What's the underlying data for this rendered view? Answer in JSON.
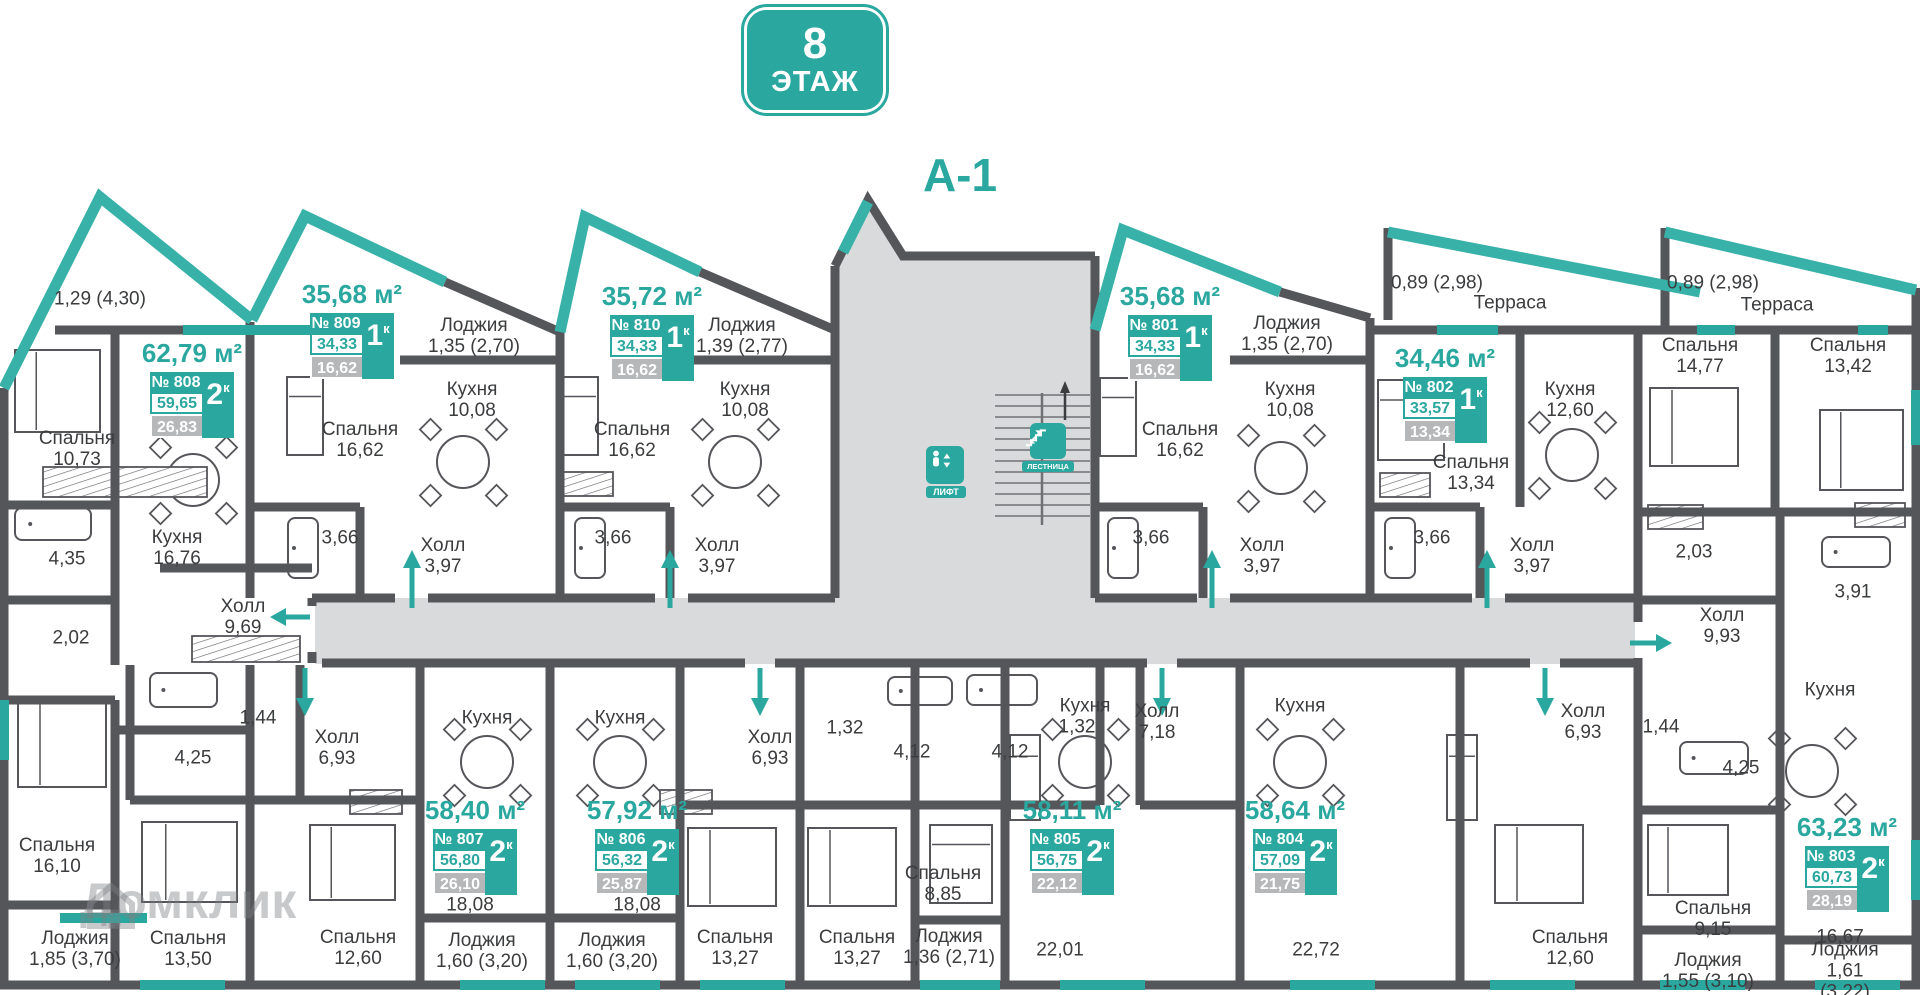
{
  "floor_badge": {
    "number": "8",
    "label": "ЭТАЖ"
  },
  "section_title": "А-1",
  "watermark": {
    "text": "Домклик"
  },
  "elevator": {
    "label": "ЛИФТ"
  },
  "stairs": {
    "label": "ЛЕСТНИЦА"
  },
  "colors": {
    "teal": "#2aa79f",
    "slant_teal": "#38b2a9",
    "wall": "#55565a",
    "shade": "#d9dadb",
    "value_gray": "#b5b7b9",
    "text": "#3b3c3e"
  },
  "apartments": [
    {
      "num": "808",
      "no": "№ 808",
      "title": "62,79 м²",
      "v1": "59,65",
      "v2": "26,83",
      "rooms": "2",
      "k": "к",
      "x": 112,
      "y": 338
    },
    {
      "num": "809",
      "no": "№ 809",
      "title": "35,68 м²",
      "v1": "34,33",
      "v2": "16,62",
      "rooms": "1",
      "k": "к",
      "x": 272,
      "y": 279
    },
    {
      "num": "810",
      "no": "№ 810",
      "title": "35,72 м²",
      "v1": "34,33",
      "v2": "16,62",
      "rooms": "1",
      "k": "к",
      "x": 572,
      "y": 281
    },
    {
      "num": "801",
      "no": "№ 801",
      "title": "35,68 м²",
      "v1": "34,33",
      "v2": "16,62",
      "rooms": "1",
      "k": "к",
      "x": 1090,
      "y": 281
    },
    {
      "num": "802",
      "no": "№ 802",
      "title": "34,46 м²",
      "v1": "33,57",
      "v2": "13,34",
      "rooms": "1",
      "k": "к",
      "x": 1365,
      "y": 343
    },
    {
      "num": "807",
      "no": "№ 807",
      "title": "58,40 м²",
      "v1": "56,80",
      "v2": "26,10",
      "rooms": "2",
      "k": "к",
      "x": 395,
      "y": 795
    },
    {
      "num": "806",
      "no": "№ 806",
      "title": "57,92 м²",
      "v1": "56,32",
      "v2": "25,87",
      "rooms": "2",
      "k": "к",
      "x": 557,
      "y": 795
    },
    {
      "num": "805",
      "no": "№ 805",
      "title": "58,11 м²",
      "v1": "56,75",
      "v2": "22,12",
      "rooms": "2",
      "k": "к",
      "x": 992,
      "y": 795
    },
    {
      "num": "804",
      "no": "№ 804",
      "title": "58,64 м²",
      "v1": "57,09",
      "v2": "21,75",
      "rooms": "2",
      "k": "к",
      "x": 1215,
      "y": 795
    },
    {
      "num": "803",
      "no": "№ 803",
      "title": "63,23 м²",
      "v1": "60,73",
      "v2": "28,19",
      "rooms": "2",
      "k": "к",
      "x": 1767,
      "y": 812
    }
  ],
  "labels": [
    {
      "t": "1,29 (4,30)",
      "x": 100,
      "y": 299
    },
    {
      "t": "Спальня\n10,73",
      "x": 77,
      "y": 449
    },
    {
      "t": "Кухня\n16,76",
      "x": 177,
      "y": 548
    },
    {
      "t": "4,35",
      "x": 67,
      "y": 559
    },
    {
      "t": "2,02",
      "x": 71,
      "y": 638
    },
    {
      "t": "Холл\n9,69",
      "x": 243,
      "y": 617
    },
    {
      "t": "Лоджия\n1,35 (2,70)",
      "x": 474,
      "y": 336
    },
    {
      "t": "Спальня\n16,62",
      "x": 360,
      "y": 440
    },
    {
      "t": "Кухня\n10,08",
      "x": 472,
      "y": 400
    },
    {
      "t": "3,66",
      "x": 340,
      "y": 538
    },
    {
      "t": "Холл\n3,97",
      "x": 443,
      "y": 556
    },
    {
      "t": "Лоджия\n1,39 (2,77)",
      "x": 742,
      "y": 336
    },
    {
      "t": "Спальня\n16,62",
      "x": 632,
      "y": 440
    },
    {
      "t": "Кухня\n10,08",
      "x": 745,
      "y": 400
    },
    {
      "t": "3,66",
      "x": 613,
      "y": 538
    },
    {
      "t": "Холл\n3,97",
      "x": 717,
      "y": 556
    },
    {
      "t": "Лоджия\n1,35 (2,70)",
      "x": 1287,
      "y": 334
    },
    {
      "t": "Спальня\n16,62",
      "x": 1180,
      "y": 440
    },
    {
      "t": "Кухня\n10,08",
      "x": 1290,
      "y": 400
    },
    {
      "t": "3,66",
      "x": 1151,
      "y": 538
    },
    {
      "t": "Холл\n3,97",
      "x": 1262,
      "y": 556
    },
    {
      "t": "0,89 (2,98)",
      "x": 1437,
      "y": 283
    },
    {
      "t": "Терраса",
      "x": 1510,
      "y": 303
    },
    {
      "t": "0,89 (2,98)",
      "x": 1713,
      "y": 283
    },
    {
      "t": "Терраса",
      "x": 1777,
      "y": 305
    },
    {
      "t": "Спальня\n13,34",
      "x": 1471,
      "y": 473
    },
    {
      "t": "Кухня\n12,60",
      "x": 1570,
      "y": 400
    },
    {
      "t": "3,66",
      "x": 1432,
      "y": 538
    },
    {
      "t": "Холл\n3,97",
      "x": 1532,
      "y": 556
    },
    {
      "t": "Спальня\n14,77",
      "x": 1700,
      "y": 356
    },
    {
      "t": "Спальня\n13,42",
      "x": 1848,
      "y": 356
    },
    {
      "t": "2,03",
      "x": 1694,
      "y": 552
    },
    {
      "t": "3,91",
      "x": 1853,
      "y": 592
    },
    {
      "t": "Холл\n9,93",
      "x": 1722,
      "y": 626
    },
    {
      "t": "Кухня",
      "x": 1830,
      "y": 690
    },
    {
      "t": "1,44",
      "x": 1661,
      "y": 727
    },
    {
      "t": "4,25",
      "x": 1741,
      "y": 768
    },
    {
      "t": "Спальня\n9,15",
      "x": 1713,
      "y": 919
    },
    {
      "t": "16,67",
      "x": 1840,
      "y": 937
    },
    {
      "t": "Лоджия\n1,61 (3,22)",
      "x": 1845,
      "y": 971
    },
    {
      "t": "Лоджия\n1,55 (3,10)",
      "x": 1708,
      "y": 971
    },
    {
      "t": "Спальня\n12,60",
      "x": 1570,
      "y": 948
    },
    {
      "t": "22,72",
      "x": 1316,
      "y": 950
    },
    {
      "t": "22,01",
      "x": 1060,
      "y": 950
    },
    {
      "t": "Спальня\n13,27",
      "x": 857,
      "y": 948
    },
    {
      "t": "Спальня\n13,27",
      "x": 735,
      "y": 948
    },
    {
      "t": "Спальня\n8,85",
      "x": 943,
      "y": 884
    },
    {
      "t": "Лоджия\n1,36 (2,71)",
      "x": 949,
      "y": 947
    },
    {
      "t": "Спальня\n12,60",
      "x": 358,
      "y": 948
    },
    {
      "t": "Лоджия\n1,60 (3,20)",
      "x": 482,
      "y": 951
    },
    {
      "t": "Лоджия\n1,60 (3,20)",
      "x": 612,
      "y": 951
    },
    {
      "t": "18,08",
      "x": 470,
      "y": 905
    },
    {
      "t": "18,08",
      "x": 637,
      "y": 905
    },
    {
      "t": "Спальня\n16,10",
      "x": 57,
      "y": 856
    },
    {
      "t": "Лоджия\n1,85 (3,70)",
      "x": 75,
      "y": 949
    },
    {
      "t": "Спальня\n13,50",
      "x": 188,
      "y": 949
    },
    {
      "t": "4,25",
      "x": 193,
      "y": 758
    },
    {
      "t": "1,44",
      "x": 258,
      "y": 718
    },
    {
      "t": "Холл\n6,93",
      "x": 337,
      "y": 748
    },
    {
      "t": "Холл\n6,93",
      "x": 770,
      "y": 748
    },
    {
      "t": "1,32",
      "x": 845,
      "y": 728
    },
    {
      "t": "4,12",
      "x": 912,
      "y": 752
    },
    {
      "t": "4,12",
      "x": 1010,
      "y": 752
    },
    {
      "t": "1,32",
      "x": 1077,
      "y": 727
    },
    {
      "t": "Холл\n7,18",
      "x": 1157,
      "y": 722
    },
    {
      "t": "Холл\n6,93",
      "x": 1583,
      "y": 722
    },
    {
      "t": "Кухня",
      "x": 487,
      "y": 718
    },
    {
      "t": "Кухня",
      "x": 620,
      "y": 718
    },
    {
      "t": "Кухня",
      "x": 1085,
      "y": 706
    },
    {
      "t": "Кухня",
      "x": 1300,
      "y": 706
    }
  ]
}
